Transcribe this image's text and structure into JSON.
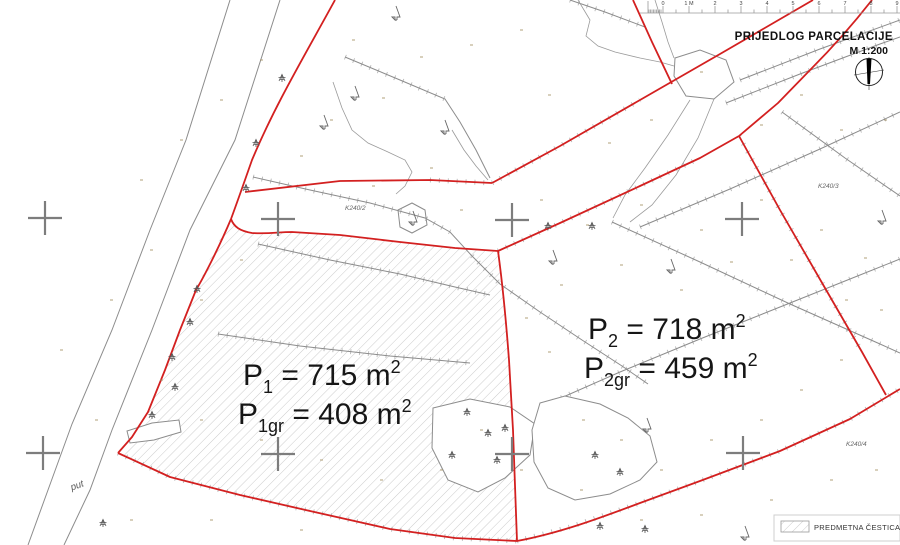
{
  "title": {
    "line1": "PRIJEDLOG PARCELACIJE",
    "line2": "M 1:200"
  },
  "ruler": {
    "labels": [
      "0",
      "1 M",
      "2",
      "3",
      "4",
      "5",
      "6",
      "7",
      "8",
      "9"
    ]
  },
  "parcels": {
    "p1": {
      "line1": {
        "base": "P",
        "sub": "1",
        "mid": " = 715 m",
        "sup": "2"
      },
      "line2": {
        "base": "P",
        "sub": "1gr",
        "mid": " = 408 m",
        "sup": "2"
      }
    },
    "p2": {
      "line1": {
        "base": "P",
        "sub": "2",
        "mid": " = 718 m",
        "sup": "2"
      },
      "line2": {
        "base": "P",
        "sub": "2gr",
        "mid": " = 459 m",
        "sup": "2"
      }
    }
  },
  "cadastral_refs": [
    {
      "label": "K240/2"
    },
    {
      "label": "K240/3"
    },
    {
      "label": "K240/4"
    }
  ],
  "road_label": "put",
  "legend": {
    "label": "PREDMETNA ČESTICA"
  },
  "colors": {
    "boundary_red": "#d32020",
    "line_gray": "#8c8c8c",
    "hatch_gray": "#bfbfbf",
    "elevation_tan": "#a48f62"
  }
}
